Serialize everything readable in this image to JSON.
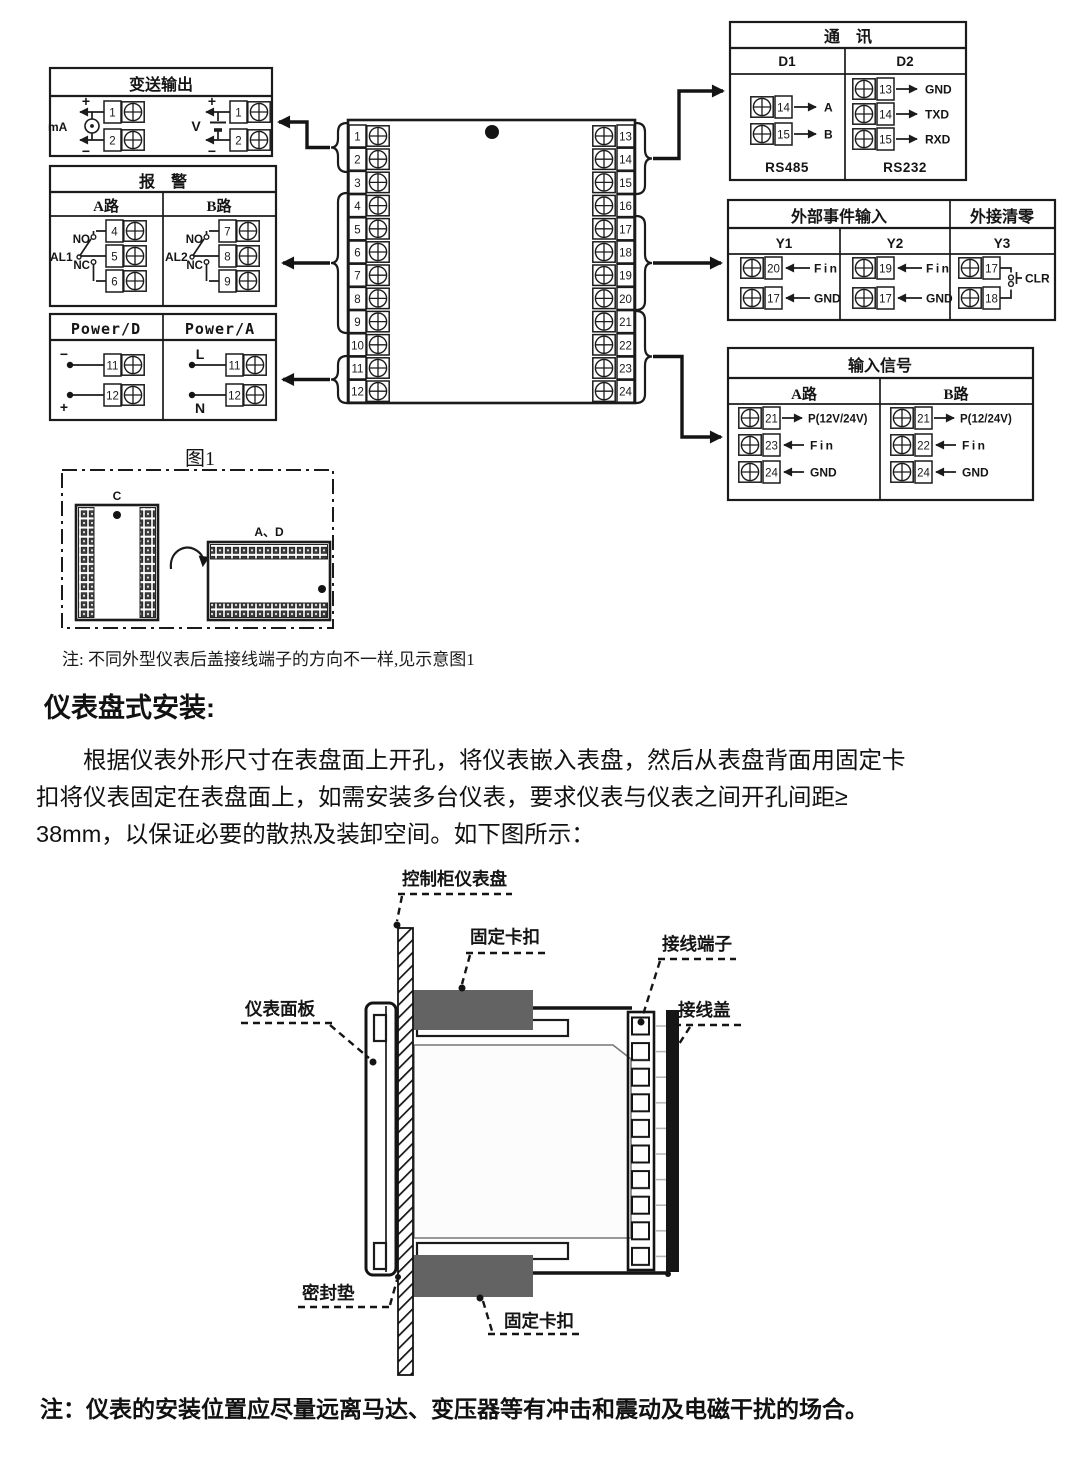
{
  "texts": {
    "fig_note": "注: 不同外型仪表后盖接线端子的方向不一样,见示意图1",
    "heading": "仪表盘式安装:",
    "para_line1": "根据仪表外形尺寸在表盘面上开孔，将仪表嵌入表盘，然后从表盘背面用固定卡",
    "para_line2": "扣将仪表固定在表盘面上，如需安装多台仪表，要求仪表与仪表之间开孔间距≥",
    "para_line3": "38mm，以保证必要的散热及装卸空间。如下图所示：",
    "bottom_note": "注：仪表的安装位置应尽量远离马达、变压器等有冲击和震动及电磁干扰的场合。"
  },
  "transmit_box": {
    "title": "变送输出",
    "ma_label": "mA",
    "v_label": "V",
    "plus": "+",
    "minus": "−",
    "ma_terminals": [
      "1",
      "2"
    ],
    "v_terminals": [
      "1",
      "2"
    ]
  },
  "alarm_box": {
    "title": "报　警",
    "col_a": "A路",
    "col_b": "B路",
    "al1": "AL1",
    "al2": "AL2",
    "no": "NO",
    "nc": "NC",
    "a_terminals": [
      "4",
      "5",
      "6"
    ],
    "b_terminals": [
      "7",
      "8",
      "9"
    ]
  },
  "power_box": {
    "col_d": "Power/D",
    "col_a": "Power/A",
    "d_minus": "−",
    "d_plus": "+",
    "a_l": "L",
    "a_n": "N",
    "d_terminals": [
      "11",
      "12"
    ],
    "a_terminals": [
      "11",
      "12"
    ]
  },
  "center_block": {
    "left": [
      "1",
      "2",
      "3",
      "4",
      "5",
      "6",
      "7",
      "8",
      "9",
      "10",
      "11",
      "12"
    ],
    "right": [
      "13",
      "14",
      "15",
      "16",
      "17",
      "18",
      "19",
      "20",
      "21",
      "22",
      "23",
      "24"
    ]
  },
  "comm_box": {
    "title": "通　讯",
    "col_d1": "D1",
    "col_d2": "D2",
    "d1_terminals": [
      "14",
      "15"
    ],
    "d1_labels": [
      "A",
      "B"
    ],
    "d1_caption": "RS485",
    "d2_terminals": [
      "13",
      "14",
      "15"
    ],
    "d2_labels": [
      "GND",
      "TXD",
      "RXD"
    ],
    "d2_caption": "RS232"
  },
  "event_box": {
    "title_events": "外部事件输入",
    "title_clear": "外接清零",
    "col_y1": "Y1",
    "col_y2": "Y2",
    "col_y3": "Y3",
    "y1_terminals": [
      "20",
      "17"
    ],
    "y2_terminals": [
      "19",
      "17"
    ],
    "y3_terminals": [
      "17",
      "18"
    ],
    "fin": "Fin",
    "gnd": "GND",
    "clr": "CLR"
  },
  "input_box": {
    "title": "输入信号",
    "col_a": "A路",
    "col_b": "B路",
    "a_terminals": [
      "21",
      "23",
      "24"
    ],
    "a_labels": [
      "P(12V/24V)",
      "Fin",
      "GND"
    ],
    "b_terminals": [
      "21",
      "22",
      "24"
    ],
    "b_labels": [
      "P(12/24V)",
      "Fin",
      "GND"
    ]
  },
  "figure1": {
    "title": "图1",
    "label_c": "C",
    "label_ad": "A、D"
  },
  "install": {
    "panel": "控制柜仪表盘",
    "clip_top": "固定卡扣",
    "terminal": "接线端子",
    "cover": "接线盖",
    "faceplate": "仪表面板",
    "gasket": "密封垫",
    "clip_bottom": "固定卡扣"
  },
  "colors": {
    "ink": "#1b1b1b",
    "clip_gray": "#636363",
    "cover_black": "#161616"
  }
}
